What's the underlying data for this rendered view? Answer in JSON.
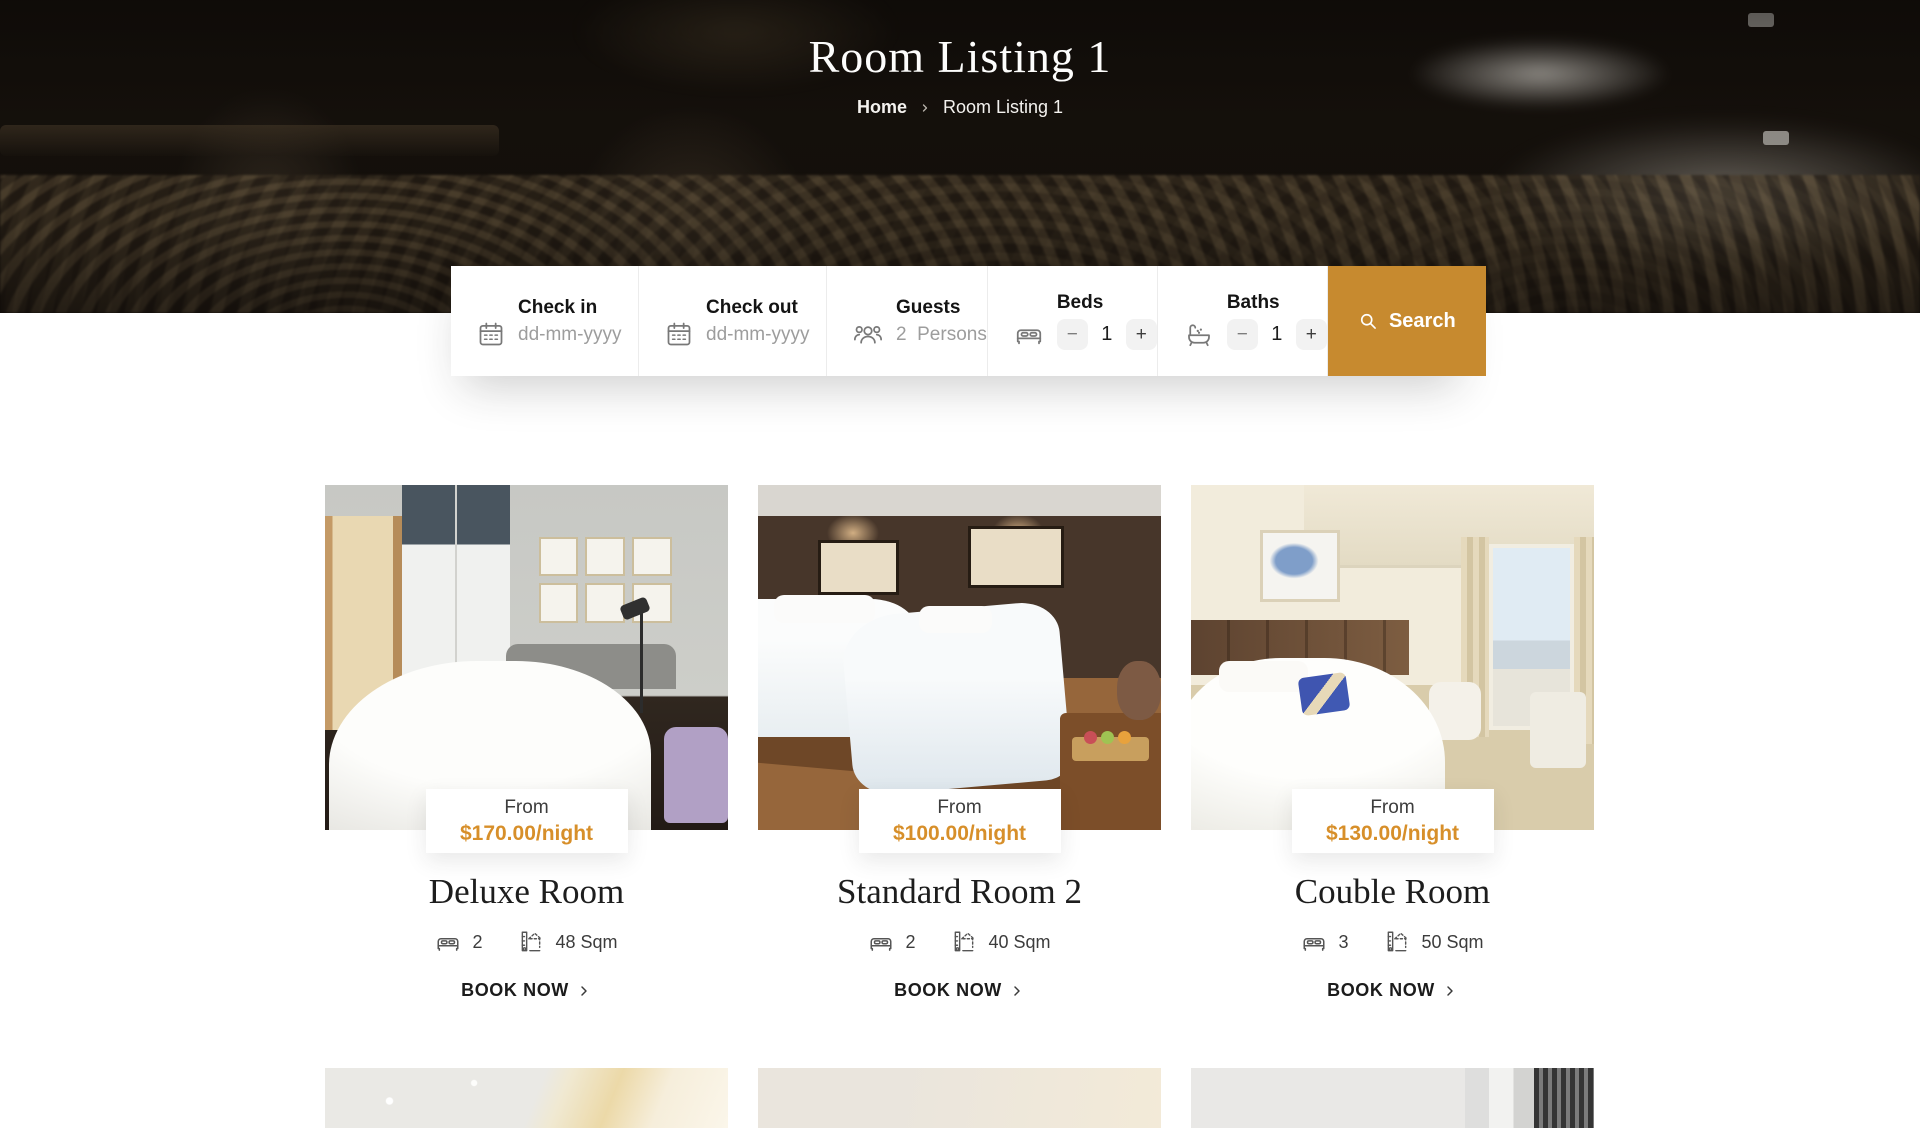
{
  "hero": {
    "title": "Room Listing 1",
    "breadcrumb": {
      "home": "Home",
      "current": "Room Listing 1"
    }
  },
  "search": {
    "check_in": {
      "label": "Check in",
      "placeholder": "dd-mm-yyyy"
    },
    "check_out": {
      "label": "Check out",
      "placeholder": "dd-mm-yyyy"
    },
    "guests": {
      "label": "Guests",
      "value": "2  Persons"
    },
    "beds": {
      "label": "Beds",
      "value": "1",
      "minus": "−",
      "plus": "+"
    },
    "baths": {
      "label": "Baths",
      "value": "1",
      "minus": "−",
      "plus": "+"
    },
    "button": {
      "label": "Search"
    }
  },
  "rooms": [
    {
      "name": "Deluxe Room",
      "price_prefix": "From",
      "price": "$170.00/night",
      "beds": "2",
      "size": "48 Sqm",
      "cta": "BOOK NOW"
    },
    {
      "name": "Standard Room 2",
      "price_prefix": "From",
      "price": "$100.00/night",
      "beds": "2",
      "size": "40 Sqm",
      "cta": "BOOK NOW"
    },
    {
      "name": "Couble Room",
      "price_prefix": "From",
      "price": "$130.00/night",
      "beds": "3",
      "size": "50 Sqm",
      "cta": "BOOK NOW"
    }
  ],
  "colors": {
    "accent_button": "#c78a2f",
    "accent_price": "#d78f2a"
  }
}
